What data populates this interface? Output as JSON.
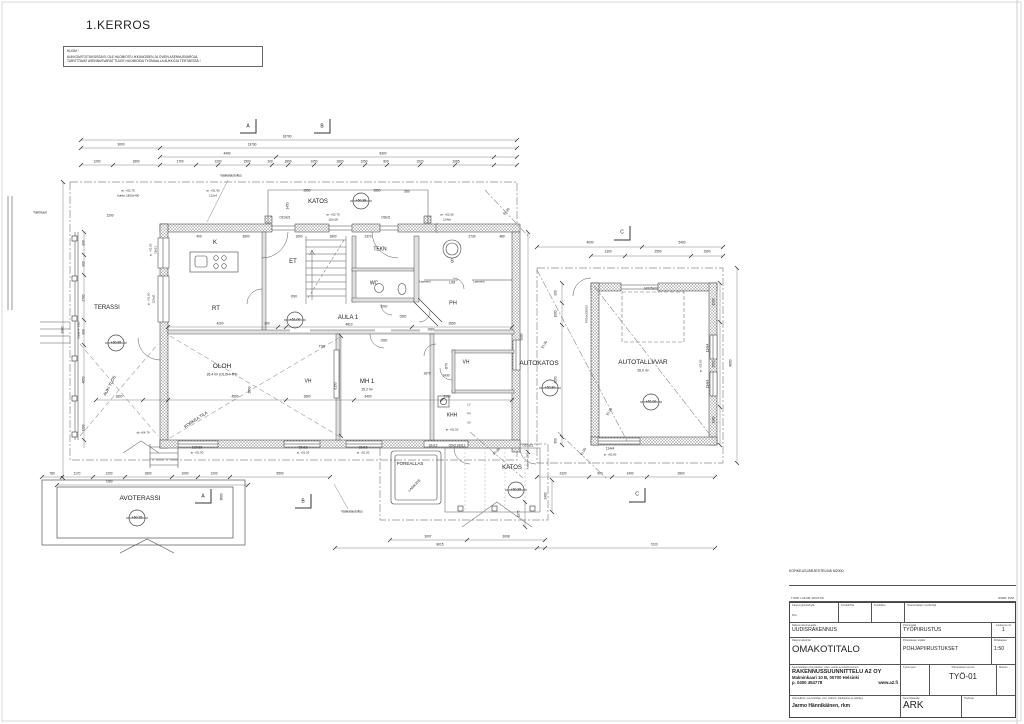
{
  "page": {
    "title": "1.KERROS"
  },
  "note": {
    "title": "HUOM !",
    "line1": "AUKKOMITOITUKSISSA EI OLE HUOMIOITU IKKUNOIDEN JA OVIEN ASENNUSVAROJA.",
    "line2": "TARVITTAVAT ASENNUSVARAT TULEE HUOMIOIDA TYÖMAALLA AUKKOJA TEHTÄESSÄ !"
  },
  "title_block": {
    "system_label": "KORKEUSJÄRJESTELMÄ N2000",
    "rev_left": "TUNN.   LUKUM.   MUUTOS",
    "rev_right": "NIMIM.   PVM",
    "kaupunginosa_label": "Kaupunginosa/Kylä",
    "kortteli_label": "Kortteli/Tila",
    "tontti_label": "Tontti/Rno",
    "viranomaiset_label": "Viranomaisten merkintöjä",
    "rno_label": "Rno",
    "toimenpide_label": "Rakennustoimenpide",
    "toimenpide": "UUDISRAKENNUS",
    "piirustuslaji_label": "Piirustuslaji",
    "piirustuslaji": "TYÖPIIRUSTUS",
    "juokseva_label": "Juokseva nro",
    "juokseva": "1",
    "kohde_label": "Rakennuskohde",
    "kohde": "OMAKOTITALO",
    "sisalto_label": "Piirustuksen sisältö",
    "sisalto": "POHJAPIIRUSTUKSET",
    "mittakaava_label": "Mittakaava",
    "mittakaava": "1:50",
    "suunnittelija_label": "Suunnittelijan yhteystiedot: yritys, osoite ja puhelinnumero",
    "yritys": "RAKENNUSSUUNNITTELU A2 OY",
    "osoite": "Malminkaari 10 B, 00700 Helsinki",
    "puhelin": "p. 0400 454778",
    "www": "www.a2.fi",
    "tyonumero_label": "Työnumero",
    "tunnus_label": "Piirustuksen tunnus",
    "tunnus": "TYÖ-01",
    "muutos_label": "Muutos",
    "vastuullinen_label": "Vastuullinen suunnittelija: nimi, tutkinto, allekirjoitus ja päiväys",
    "vastuullinen": "Jarmo Hännikäinen, rkm",
    "ala_label": "Suunnitteluala",
    "ala": "ARK",
    "tiedosto_label": "Tiedosto"
  },
  "plan": {
    "annotations": [
      {
        "t": "TERASSI",
        "x": 107,
        "y": 308,
        "s": 6,
        "n": "room-terassi"
      },
      {
        "t": "K",
        "x": 215,
        "y": 243,
        "s": 6,
        "n": "room-keittio"
      },
      {
        "t": "RT",
        "x": 216,
        "y": 309,
        "s": 6,
        "n": "room-rt"
      },
      {
        "t": "ET",
        "x": 293,
        "y": 262,
        "s": 6,
        "n": "room-et"
      },
      {
        "t": "OLOH",
        "x": 222,
        "y": 367,
        "s": 6.5,
        "n": "room-oloh"
      },
      {
        "t": "26.4 m² (OLOH+RT)",
        "x": 222,
        "y": 375,
        "s": 3.4
      },
      {
        "t": "AULA 1",
        "x": 348,
        "y": 318,
        "s": 6,
        "n": "room-aula1"
      },
      {
        "t": "TEKN",
        "x": 380,
        "y": 250,
        "s": 5,
        "n": "room-tekn"
      },
      {
        "t": "WC",
        "x": 374,
        "y": 284,
        "s": 5,
        "n": "room-wc"
      },
      {
        "t": "S",
        "x": 452,
        "y": 262,
        "s": 5,
        "n": "room-sauna"
      },
      {
        "t": "PH",
        "x": 453,
        "y": 304,
        "s": 5.5,
        "n": "room-ph"
      },
      {
        "t": "KHH",
        "x": 452,
        "y": 416,
        "s": 5,
        "n": "room-khh"
      },
      {
        "t": "VH",
        "x": 308,
        "y": 382,
        "s": 5,
        "n": "room-vh-1"
      },
      {
        "t": "VH",
        "x": 466,
        "y": 363,
        "s": 5,
        "n": "room-vh-2"
      },
      {
        "t": "MH 1",
        "x": 367,
        "y": 382,
        "s": 6,
        "n": "room-mh1"
      },
      {
        "t": "15.2 m²",
        "x": 367,
        "y": 390,
        "s": 3.4
      },
      {
        "t": "KATOS",
        "x": 318,
        "y": 202,
        "s": 6,
        "n": "room-katos-top"
      },
      {
        "t": "KATOS",
        "x": 512,
        "y": 468,
        "s": 6,
        "n": "room-katos-bottom"
      },
      {
        "t": "POREALLAS",
        "x": 410,
        "y": 464,
        "s": 4.5,
        "n": "poreallas-label"
      },
      {
        "t": "AVOTERASSI",
        "x": 140,
        "y": 499,
        "s": 6.5,
        "n": "room-avoterassi"
      },
      {
        "t": "AUTOKATOS",
        "x": 539,
        "y": 364,
        "s": 6.5,
        "n": "room-autokatos"
      },
      {
        "t": "AUTOTALLI/VAR",
        "x": 643,
        "y": 363,
        "s": 6.5,
        "n": "room-autotalli"
      },
      {
        "t": "26.0 m²",
        "x": 643,
        "y": 371,
        "s": 3.4
      },
      {
        "t": "+50.85",
        "x": 116,
        "y": 343,
        "s": 3.4,
        "n": "level-mark"
      },
      {
        "t": "+51.00",
        "x": 295,
        "y": 320,
        "s": 3.4,
        "n": "level-mark"
      },
      {
        "t": "+50.98",
        "x": 361,
        "y": 201,
        "s": 3.4,
        "n": "level-mark"
      },
      {
        "t": "+50.85",
        "x": 516,
        "y": 490,
        "s": 3.4,
        "n": "level-mark"
      },
      {
        "t": "+50.35",
        "x": 137,
        "y": 518,
        "s": 3.4,
        "n": "level-mark"
      },
      {
        "t": "+50.80",
        "x": 550,
        "y": 388,
        "s": 3.4,
        "n": "level-mark"
      },
      {
        "t": "+51.00",
        "x": 651,
        "y": 402,
        "s": 3.4,
        "n": "level-mark"
      },
      {
        "t": "O10x21",
        "x": 285,
        "y": 218
      },
      {
        "t": "O9x21",
        "x": 386,
        "y": 218
      },
      {
        "t": "ar. +52.70",
        "x": 333,
        "y": 215,
        "s": 3
      },
      {
        "t": "110x18",
        "x": 333,
        "y": 220,
        "s": 3
      },
      {
        "t": "ar. +52.50",
        "x": 447,
        "y": 215,
        "s": 3
      },
      {
        "t": "114x6",
        "x": 447,
        "y": 220,
        "s": 3
      },
      {
        "t": "ar. +52.70",
        "x": 128,
        "y": 191,
        "s": 3
      },
      {
        "t": "Aukko 1800x400",
        "x": 128,
        "y": 196,
        "s": 3
      },
      {
        "t": "ar. +51.90",
        "x": 213,
        "y": 191,
        "s": 3
      },
      {
        "t": "112x4",
        "x": 213,
        "y": 196,
        "s": 3
      },
      {
        "t": "Vaakalaudoitus",
        "x": 231,
        "y": 176,
        "s": 3.2
      },
      {
        "t": "Vaakalaudoitus",
        "x": 352,
        "y": 512,
        "s": 3.2
      },
      {
        "t": "Tukimuuri",
        "x": 40,
        "y": 213,
        "s": 3.2
      },
      {
        "t": "O9V",
        "x": 294,
        "y": 297
      },
      {
        "t": "O9O",
        "x": 384,
        "y": 307
      },
      {
        "t": "O9O",
        "x": 384,
        "y": 341
      },
      {
        "t": "O8O",
        "x": 403,
        "y": 317
      },
      {
        "t": "O8O",
        "x": 431,
        "y": 330
      },
      {
        "t": "TO8",
        "x": 322,
        "y": 347
      },
      {
        "t": "LO8",
        "x": 452,
        "y": 283
      },
      {
        "t": "Lasiseinä",
        "x": 425,
        "y": 283,
        "s": 2.7
      },
      {
        "t": "Lasiseinä",
        "x": 479,
        "y": 283,
        "s": 2.7
      },
      {
        "t": "O7V",
        "x": 447,
        "y": 366,
        "r": -90
      },
      {
        "t": "NO25x22",
        "x": 651,
        "y": 289
      },
      {
        "t": "PO10x22/EI15",
        "x": 587,
        "y": 314,
        "r": -90,
        "s": 2.8
      },
      {
        "t": "114x4",
        "x": 708,
        "y": 348,
        "r": -90
      },
      {
        "t": "114x4",
        "x": 708,
        "y": 384,
        "r": -90
      },
      {
        "t": "ar. +52.80",
        "x": 701,
        "y": 366,
        "r": -90,
        "s": 2.8
      },
      {
        "t": "114x4",
        "x": 610,
        "y": 449
      },
      {
        "t": "ar. +52.80",
        "x": 610,
        "y": 455,
        "s": 2.8
      },
      {
        "t": "O10x21",
        "x": 528,
        "y": 446
      },
      {
        "t": "O9x21/EI12",
        "x": 457,
        "y": 446
      },
      {
        "t": "16x12",
        "x": 433,
        "y": 446
      },
      {
        "t": "112x18",
        "x": 197,
        "y": 448
      },
      {
        "t": "ar. +51.50",
        "x": 197,
        "y": 453,
        "s": 2.8
      },
      {
        "t": "15x16",
        "x": 303,
        "y": 448
      },
      {
        "t": "ar. +51.50",
        "x": 303,
        "y": 453,
        "s": 2.8
      },
      {
        "t": "15x16",
        "x": 363,
        "y": 448
      },
      {
        "t": "ar. +51.50",
        "x": 363,
        "y": 453,
        "s": 2.8
      },
      {
        "t": "ar. +51.00",
        "x": 151,
        "y": 250,
        "r": -90,
        "s": 2.8
      },
      {
        "t": "19x21",
        "x": 156,
        "y": 250,
        "r": -90,
        "s": 2.8
      },
      {
        "t": "ar. +51.00",
        "x": 149,
        "y": 299,
        "r": -90,
        "s": 2.8
      },
      {
        "t": "122x21",
        "x": 154,
        "y": 299,
        "r": -90,
        "s": 2.8
      },
      {
        "t": "yk +54.70",
        "x": 143,
        "y": 433,
        "s": 3
      },
      {
        "t": "ar. +51.50",
        "x": 452,
        "y": 430,
        "s": 2.8
      },
      {
        "t": "LV",
        "x": 469,
        "y": 406,
        "s": 2.6
      },
      {
        "t": "PV",
        "x": 469,
        "y": 415,
        "s": 2.6
      },
      {
        "t": "SV",
        "x": 469,
        "y": 424,
        "s": 2.6
      },
      {
        "t": "AUKI YLÖS",
        "x": 110,
        "y": 386,
        "r": -62,
        "s": 4.2
      },
      {
        "t": "KORKEA TILA",
        "x": 196,
        "y": 420,
        "r": -33,
        "s": 4.2
      },
      {
        "t": "LASIKATE",
        "x": 415,
        "y": 486,
        "r": -45,
        "s": 3.4
      },
      {
        "t": "EI-30",
        "x": 507,
        "y": 212,
        "r": -50,
        "s": 3.4
      },
      {
        "t": "EI-30",
        "x": 545,
        "y": 345,
        "r": -58,
        "s": 3.4
      },
      {
        "t": "EI-30",
        "x": 610,
        "y": 412,
        "r": -58,
        "s": 3.4
      },
      {
        "t": "EI-30",
        "x": 497,
        "y": 452,
        "r": -45,
        "s": 3.4
      },
      {
        "t": "EI-30",
        "x": 584,
        "y": 452,
        "r": -60,
        "s": 3.4
      },
      {
        "t": "Kaide H=1000",
        "x": 80,
        "y": 330,
        "r": -90,
        "s": 2.7
      },
      {
        "t": "Kaide h=1000",
        "x": 529,
        "y": 461,
        "r": -90,
        "s": 2.7
      },
      {
        "t": "A",
        "x": 248,
        "y": 127,
        "s": 5,
        "n": "section-marker-a-top"
      },
      {
        "t": "B",
        "x": 322,
        "y": 127,
        "s": 5,
        "n": "section-marker-b-top"
      },
      {
        "t": "C",
        "x": 622,
        "y": 233,
        "s": 5,
        "n": "section-marker-c-top"
      },
      {
        "t": "A",
        "x": 203,
        "y": 497,
        "s": 5,
        "n": "section-marker-a-bottom"
      },
      {
        "t": "B",
        "x": 303,
        "y": 502,
        "s": 5,
        "n": "section-marker-b-bottom"
      },
      {
        "t": "C",
        "x": 637,
        "y": 495,
        "s": 5,
        "n": "section-marker-c-bottom"
      },
      {
        "t": "16700",
        "x": 287,
        "y": 137
      },
      {
        "t": "3000",
        "x": 121,
        "y": 145
      },
      {
        "t": "13700",
        "x": 252,
        "y": 145
      },
      {
        "t": "4400",
        "x": 227,
        "y": 154
      },
      {
        "t": "8300",
        "x": 383,
        "y": 154
      },
      {
        "t": "1200",
        "x": 97,
        "y": 162
      },
      {
        "t": "1800",
        "x": 136,
        "y": 162
      },
      {
        "t": "1700",
        "x": 180,
        "y": 162
      },
      {
        "t": "1200",
        "x": 218,
        "y": 162
      },
      {
        "t": "1500",
        "x": 247,
        "y": 162
      },
      {
        "t": "200",
        "x": 270,
        "y": 162
      },
      {
        "t": "1800",
        "x": 288,
        "y": 162
      },
      {
        "t": "1050",
        "x": 314,
        "y": 162
      },
      {
        "t": "1800",
        "x": 340,
        "y": 162
      },
      {
        "t": "1050",
        "x": 364,
        "y": 162
      },
      {
        "t": "800",
        "x": 386,
        "y": 162
      },
      {
        "t": "1520",
        "x": 420,
        "y": 162
      },
      {
        "t": "1065",
        "x": 456,
        "y": 162
      },
      {
        "t": "2850",
        "x": 307,
        "y": 191
      },
      {
        "t": "2850",
        "x": 377,
        "y": 191
      },
      {
        "t": "580",
        "x": 407,
        "y": 192
      },
      {
        "t": "1450",
        "x": 288,
        "y": 206,
        "r": -90
      },
      {
        "t": "400",
        "x": 199,
        "y": 237
      },
      {
        "t": "3600",
        "x": 246,
        "y": 237
      },
      {
        "t": "1600",
        "x": 299,
        "y": 237
      },
      {
        "t": "1800",
        "x": 333,
        "y": 237
      },
      {
        "t": "2370",
        "x": 368,
        "y": 237
      },
      {
        "t": "2730",
        "x": 472,
        "y": 237
      },
      {
        "t": "480",
        "x": 502,
        "y": 237
      },
      {
        "t": "4200",
        "x": 220,
        "y": 324
      },
      {
        "t": "300",
        "x": 267,
        "y": 324
      },
      {
        "t": "4810",
        "x": 349,
        "y": 325
      },
      {
        "t": "2650",
        "x": 452,
        "y": 324
      },
      {
        "t": "1800",
        "x": 119,
        "y": 397
      },
      {
        "t": "4500",
        "x": 235,
        "y": 397
      },
      {
        "t": "1800",
        "x": 307,
        "y": 397
      },
      {
        "t": "3400",
        "x": 368,
        "y": 397
      },
      {
        "t": "3100",
        "x": 447,
        "y": 397
      },
      {
        "t": "1670",
        "x": 427,
        "y": 374
      },
      {
        "t": "1430",
        "x": 446,
        "y": 376
      },
      {
        "t": "6150",
        "x": 336,
        "y": 386,
        "r": -90
      },
      {
        "t": "2800",
        "x": 250,
        "y": 390,
        "r": -90
      },
      {
        "t": "900",
        "x": 84,
        "y": 243,
        "r": -90
      },
      {
        "t": "900",
        "x": 84,
        "y": 264,
        "r": -90
      },
      {
        "t": "2700",
        "x": 84,
        "y": 298,
        "r": -90
      },
      {
        "t": "900",
        "x": 84,
        "y": 332,
        "r": -90
      },
      {
        "t": "4650",
        "x": 84,
        "y": 380,
        "r": -90
      },
      {
        "t": "1200",
        "x": 84,
        "y": 428,
        "r": -90
      },
      {
        "t": "9900",
        "x": 63,
        "y": 330,
        "r": -90
      },
      {
        "t": "1200",
        "x": 110,
        "y": 216
      },
      {
        "t": "9080",
        "x": 522,
        "y": 337,
        "r": -90
      },
      {
        "t": "1900",
        "x": 714,
        "y": 302,
        "r": -90
      },
      {
        "t": "3500",
        "x": 714,
        "y": 364,
        "r": -90
      },
      {
        "t": "1900",
        "x": 714,
        "y": 420,
        "r": -90
      },
      {
        "t": "8600",
        "x": 731,
        "y": 363,
        "r": -90
      },
      {
        "t": "4000",
        "x": 590,
        "y": 243
      },
      {
        "t": "5400",
        "x": 682,
        "y": 243
      },
      {
        "t": "1300",
        "x": 608,
        "y": 252
      },
      {
        "t": "2500",
        "x": 658,
        "y": 252
      },
      {
        "t": "1500",
        "x": 707,
        "y": 252
      },
      {
        "t": "900",
        "x": 556,
        "y": 293,
        "r": -90
      },
      {
        "t": "1000",
        "x": 556,
        "y": 314,
        "r": -90
      },
      {
        "t": "4500",
        "x": 556,
        "y": 380,
        "r": -90
      },
      {
        "t": "300",
        "x": 556,
        "y": 441,
        "r": -90
      },
      {
        "t": "2320",
        "x": 563,
        "y": 474
      },
      {
        "t": "900",
        "x": 600,
        "y": 474
      },
      {
        "t": "1400",
        "x": 630,
        "y": 474
      },
      {
        "t": "2800",
        "x": 681,
        "y": 474
      },
      {
        "t": "2400",
        "x": 546,
        "y": 496,
        "r": -90
      },
      {
        "t": "1175",
        "x": 519,
        "y": 514,
        "r": -90
      },
      {
        "t": "3007",
        "x": 428,
        "y": 537
      },
      {
        "t": "3008",
        "x": 506,
        "y": 537
      },
      {
        "t": "8015",
        "x": 440,
        "y": 545
      },
      {
        "t": "7220",
        "x": 654,
        "y": 545
      },
      {
        "t": "780",
        "x": 52,
        "y": 474
      },
      {
        "t": "1170",
        "x": 77,
        "y": 474
      },
      {
        "t": "1200",
        "x": 109,
        "y": 474
      },
      {
        "t": "1800",
        "x": 148,
        "y": 474
      },
      {
        "t": "1000",
        "x": 185,
        "y": 474
      },
      {
        "t": "1200",
        "x": 214,
        "y": 474
      },
      {
        "t": "5500",
        "x": 280,
        "y": 474
      },
      {
        "t": "7280",
        "x": 109,
        "y": 482
      },
      {
        "t": "3600",
        "x": 222,
        "y": 497,
        "r": -90
      }
    ]
  }
}
